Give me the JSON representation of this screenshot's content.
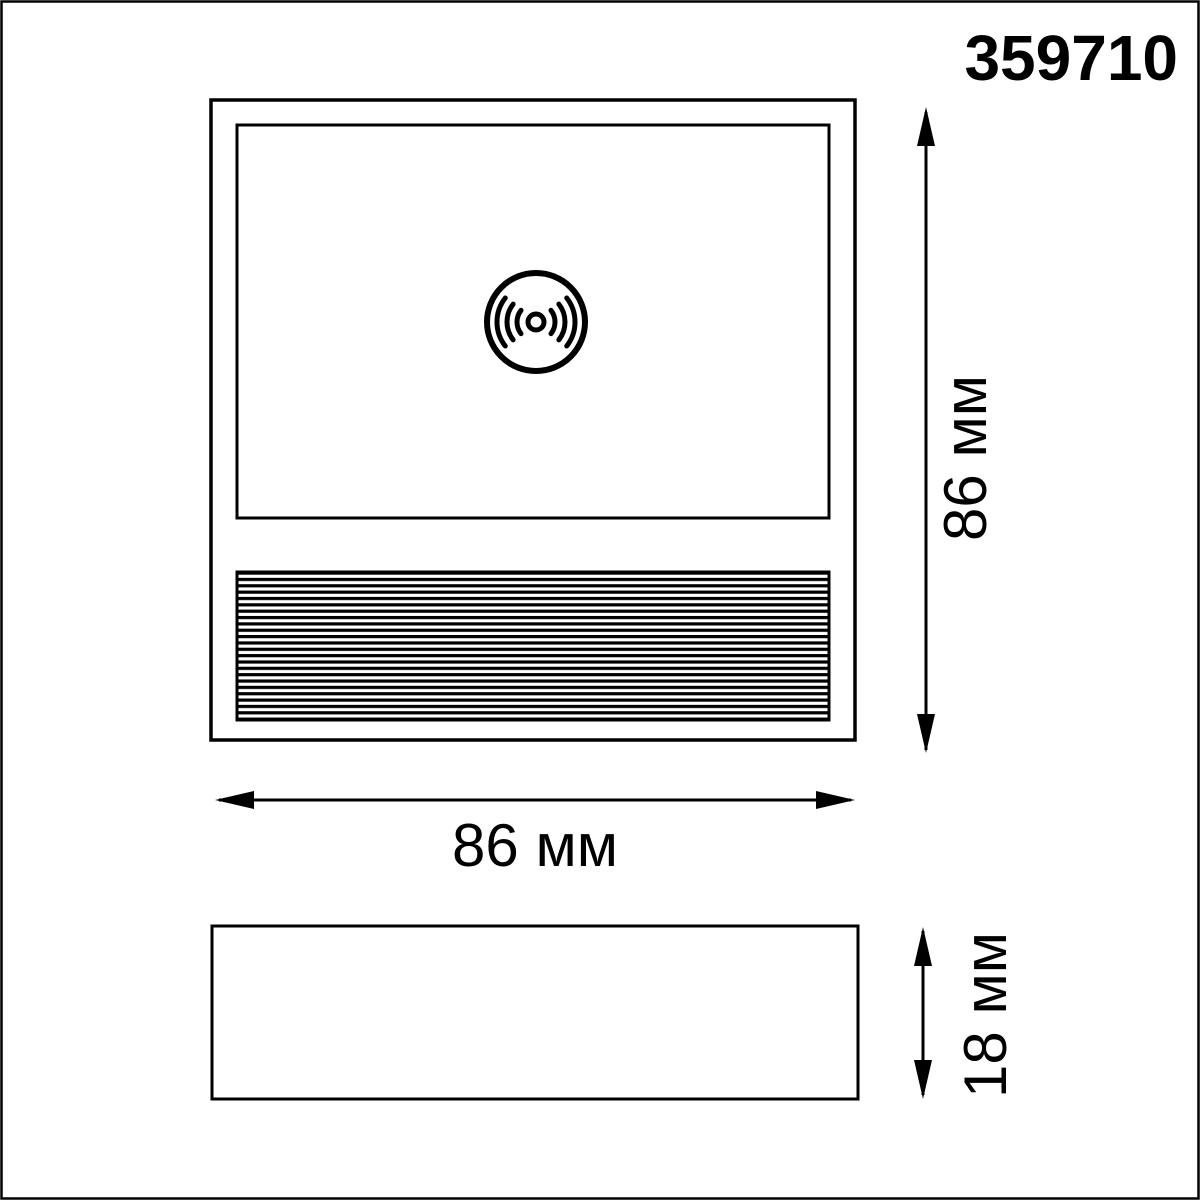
{
  "product": {
    "article_number": "359710"
  },
  "drawing": {
    "front_view": {
      "width": {
        "value": 86,
        "unit": "мм",
        "label": "86 мм"
      },
      "height": {
        "value": 86,
        "unit": "мм",
        "label": "86 мм"
      }
    },
    "side_view": {
      "depth": {
        "value": 18,
        "unit": "мм",
        "label": "18 мм"
      }
    },
    "icon": "wireless-sensor-icon",
    "colors": {
      "line": "#000000",
      "background": "#ffffff"
    }
  }
}
